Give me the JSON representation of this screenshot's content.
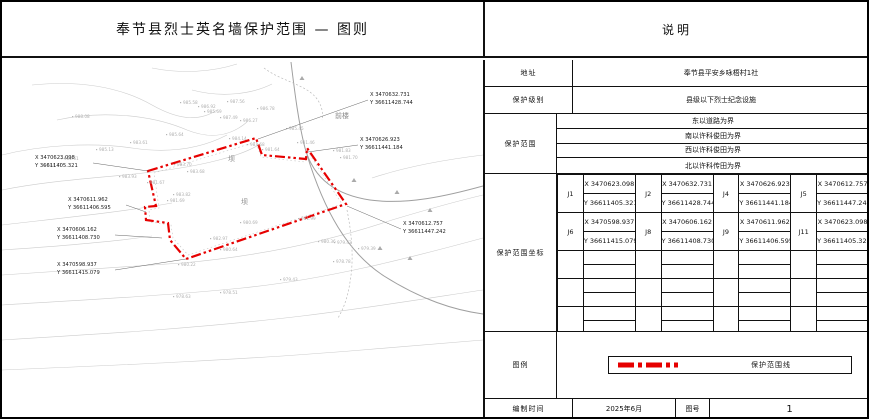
{
  "title": "奉节县烈士英名墙保护范围 — 图则",
  "panel_header": "说明",
  "info": {
    "address_label": "地址",
    "address_value": "奉节县平安乡咏梧村1社",
    "level_label": "保护级别",
    "level_value": "县级以下烈士纪念设施",
    "scope_label": "保护范围",
    "scope_items": [
      "东以道路为界",
      "南以许科俊田为界",
      "西以许科俊田为界",
      "北以许科传田为界"
    ]
  },
  "coords": {
    "label": "保护范围坐标",
    "rows": [
      [
        {
          "id": "J1",
          "x": "X 3470623.098",
          "y": "Y 36611405.321"
        },
        {
          "id": "J2",
          "x": "X 3470632.731",
          "y": "Y 36611428.744"
        },
        {
          "id": "J4",
          "x": "X 3470626.923",
          "y": "Y 36611441.184"
        },
        {
          "id": "J5",
          "x": "X 3470612.757",
          "y": "Y 36611447.242"
        }
      ],
      [
        {
          "id": "J6",
          "x": "X 3470598.937",
          "y": "Y 36611415.079"
        },
        {
          "id": "J8",
          "x": "X 3470606.162",
          "y": "Y 36611408.730"
        },
        {
          "id": "J9",
          "x": "X 3470611.962",
          "y": "Y 36611406.595"
        },
        {
          "id": "J11",
          "x": "X 3470623.098",
          "y": "Y 36611405.321"
        }
      ]
    ],
    "empty_groups": 3
  },
  "legend": {
    "label": "图例",
    "line_label": "保护范围线",
    "line_color": "#e60000"
  },
  "footer": {
    "date_label": "编制时间",
    "date_value": "2025年6月",
    "sheet_label": "图号",
    "sheet_value": "1"
  },
  "map": {
    "boundary_color": "#e60000",
    "labels": [
      {
        "x": 333,
        "y": 58,
        "t": "前楼"
      },
      {
        "x": 226,
        "y": 101,
        "t": "坝"
      },
      {
        "x": 239,
        "y": 144,
        "t": "坝"
      }
    ],
    "callouts": [
      {
        "x": 33,
        "y": 99,
        "l1": "X 3470623.098",
        "l2": "Y 36611405.321",
        "tx": 146,
        "ty": 111
      },
      {
        "x": 66,
        "y": 141,
        "l1": "X 3470611.962",
        "l2": "Y 36611406.595",
        "tx": 144,
        "ty": 152
      },
      {
        "x": 55,
        "y": 171,
        "l1": "X 3470606.162",
        "l2": "Y 36611408.730",
        "tx": 160,
        "ty": 178
      },
      {
        "x": 55,
        "y": 206,
        "l1": "X 3470598.937",
        "l2": "Y 36611415.079",
        "tx": 184,
        "ty": 199
      },
      {
        "x": 368,
        "y": 36,
        "l1": "X 3470632.731",
        "l2": "Y 36611428.744",
        "tx": 256,
        "ty": 79
      },
      {
        "x": 358,
        "y": 81,
        "l1": "X 3470626.923",
        "l2": "Y 36611441.184",
        "tx": 306,
        "ty": 92
      },
      {
        "x": 401,
        "y": 165,
        "l1": "X 3470612.757",
        "l2": "Y 36611447.242",
        "tx": 345,
        "ty": 146
      }
    ],
    "spots": [
      {
        "x": 73,
        "y": 58,
        "v": "988.08"
      },
      {
        "x": 181,
        "y": 44,
        "v": "985.58"
      },
      {
        "x": 199,
        "y": 48,
        "v": "986.92"
      },
      {
        "x": 205,
        "y": 53,
        "v": "985.69"
      },
      {
        "x": 228,
        "y": 43,
        "v": "987.56"
      },
      {
        "x": 221,
        "y": 59,
        "v": "987.49"
      },
      {
        "x": 241,
        "y": 62,
        "v": "986.27"
      },
      {
        "x": 258,
        "y": 50,
        "v": "986.78"
      },
      {
        "x": 287,
        "y": 70,
        "v": "985.45"
      },
      {
        "x": 167,
        "y": 76,
        "v": "985.64"
      },
      {
        "x": 131,
        "y": 84,
        "v": "983.61"
      },
      {
        "x": 97,
        "y": 91,
        "v": "985.13"
      },
      {
        "x": 62,
        "y": 100,
        "v": "982.61"
      },
      {
        "x": 45,
        "y": 107,
        "v": "984.77"
      },
      {
        "x": 120,
        "y": 118,
        "v": "983.93"
      },
      {
        "x": 148,
        "y": 124,
        "v": "981.67"
      },
      {
        "x": 230,
        "y": 80,
        "v": "984.14"
      },
      {
        "x": 248,
        "y": 86,
        "v": "983.68"
      },
      {
        "x": 263,
        "y": 91,
        "v": "981.64"
      },
      {
        "x": 298,
        "y": 84,
        "v": "981.46"
      },
      {
        "x": 334,
        "y": 92,
        "v": "981.83"
      },
      {
        "x": 341,
        "y": 99,
        "v": "981.70"
      },
      {
        "x": 175,
        "y": 106,
        "v": "983.70"
      },
      {
        "x": 188,
        "y": 113,
        "v": "983.68"
      },
      {
        "x": 174,
        "y": 136,
        "v": "983.82"
      },
      {
        "x": 168,
        "y": 142,
        "v": "981.69"
      },
      {
        "x": 299,
        "y": 160,
        "v": "981.99"
      },
      {
        "x": 211,
        "y": 180,
        "v": "982.97"
      },
      {
        "x": 221,
        "y": 191,
        "v": "980.64"
      },
      {
        "x": 241,
        "y": 164,
        "v": "980.69"
      },
      {
        "x": 319,
        "y": 183,
        "v": "980.36"
      },
      {
        "x": 335,
        "y": 184,
        "v": "979.42"
      },
      {
        "x": 359,
        "y": 190,
        "v": "979.39"
      },
      {
        "x": 334,
        "y": 203,
        "v": "978.78"
      },
      {
        "x": 281,
        "y": 221,
        "v": "979.43"
      },
      {
        "x": 221,
        "y": 234,
        "v": "978.51"
      },
      {
        "x": 174,
        "y": 238,
        "v": "978.63"
      },
      {
        "x": 179,
        "y": 206,
        "v": "980.22"
      }
    ]
  }
}
